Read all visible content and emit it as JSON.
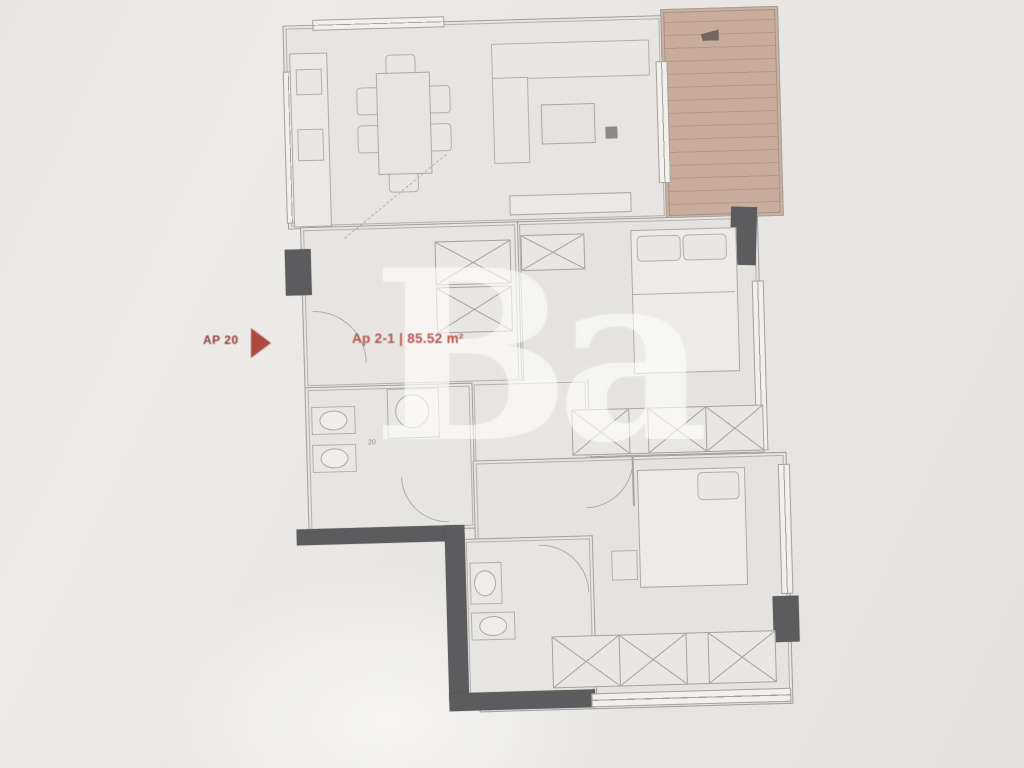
{
  "plan": {
    "unit_badge": "AP 20",
    "area_label": "Ap 2-1 | 85.52 m²",
    "watermark": "Ba",
    "dimension_marks": {
      "bathroom": "20",
      "bedroom2": "20"
    }
  },
  "colors": {
    "paper": "#e8e6e3",
    "line": "#a5a29c",
    "wall_dark": "#5c5c5e",
    "terrace_fill": "#c8ac9d",
    "accent_red": "#ac4a40",
    "watermark_white": "rgba(255,255,255,0.52)"
  }
}
